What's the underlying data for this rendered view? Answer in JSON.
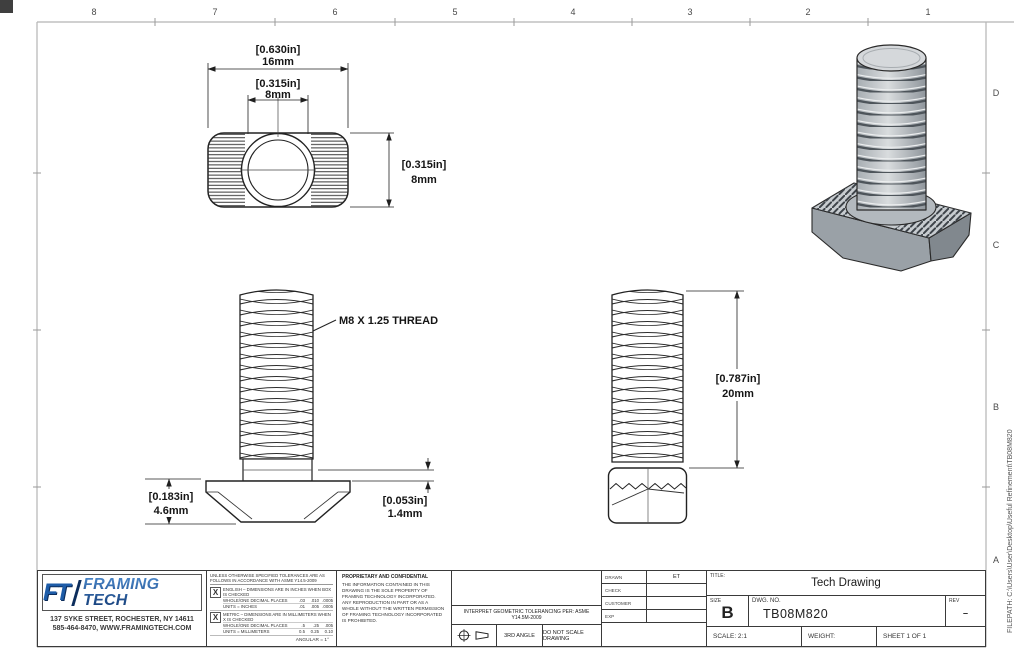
{
  "frame": {
    "zones_top": [
      "8",
      "7",
      "6",
      "5",
      "4",
      "3",
      "2",
      "1"
    ],
    "zones_right": [
      "D",
      "C",
      "B",
      "A"
    ],
    "filepath": "FILEPATH: C:\\Users\\User\\Desktop\\Useful Refinement\\TB08M820"
  },
  "views": {
    "top": {
      "width_in": "[0.630in]",
      "width_mm": "16mm",
      "slot_in": "[0.315in]",
      "slot_mm": "8mm",
      "height_in": "[0.315in]",
      "height_mm": "8mm"
    },
    "front": {
      "thread_callout": "M8 X 1.25 THREAD",
      "head_in": "[0.183in]",
      "head_mm": "4.6mm",
      "lip_in": "[0.053in]",
      "lip_mm": "1.4mm"
    },
    "side": {
      "length_in": "[0.787in]",
      "length_mm": "20mm"
    }
  },
  "title_block": {
    "logo": {
      "monogram": "FT",
      "name": "FRAMING TECH"
    },
    "address1": "137 SYKE STREET, ROCHESTER, NY 14611",
    "address2": "585-464-8470, WWW.FRAMINGTECH.COM",
    "tol": {
      "header": "UNLESS OTHERWISE SPECIFIED TOLERANCES ARE AS FOLLOWS IN ACCORDANCE WITH ASME Y14.5-2009",
      "check": "X",
      "eng_label": "ENGLISH – DIMENSIONS ARE IN INCHES WHEN BOX IS CHECKED",
      "eng_r1": "WHOLE/ONE DECIMAL PLACES",
      "eng_r1v": [
        ".03",
        ".010",
        ".0005"
      ],
      "eng_r2": "UNITS = INCHES",
      "eng_r2v": [
        ".01",
        ".005",
        ".0005"
      ],
      "met_label": "METRIC – DIMENSIONS ARE IN MILLIMETERS WHEN X IS CHECKED",
      "met_r1": "WHOLE/ONE DECIMAL PLACES",
      "met_r1v": [
        ".5",
        ".25",
        ".005"
      ],
      "met_r2": "UNITS = MILLIMETERS",
      "met_r2v": [
        "0.5",
        "0.25",
        "0.10"
      ],
      "angular": "ANGULAR = 1°"
    },
    "proprietary_title": "PROPRIETARY AND CONFIDENTIAL",
    "proprietary_body": "THE INFORMATION CONTAINED IN THIS DRAWING IS THE SOLE PROPERTY OF FRAMING TECHNOLOGY INCORPORATED. ANY REPRODUCTION IN PART OR AS A WHOLE WITHOUT THE WRITTEN PERMISSION OF FRAMING TECHNOLOGY INCORPORATED IS PROHIBITED.",
    "interpret": "INTERPRET GEOMETRIC TOLERANCING PER: ASME Y14.5M-2009",
    "third_angle": "3RD ANGLE",
    "do_not_scale": "DO NOT SCALE DRAWING",
    "fields": {
      "drawn_label": "DRAWN",
      "drawn_value": "ET",
      "check_label": "CHECK",
      "customer_label": "CUSTOMER",
      "exp_label": "EXP"
    },
    "title_label": "TITLE:",
    "title_value": "Tech Drawing",
    "size_label": "SIZE",
    "size_value": "B",
    "dwg_label": "DWG. NO.",
    "dwg_value": "TB08M820",
    "rev_label": "REV",
    "rev_value": "–",
    "scale": "SCALE: 2:1",
    "weight": "WEIGHT:",
    "sheet": "SHEET 1 OF 1"
  }
}
